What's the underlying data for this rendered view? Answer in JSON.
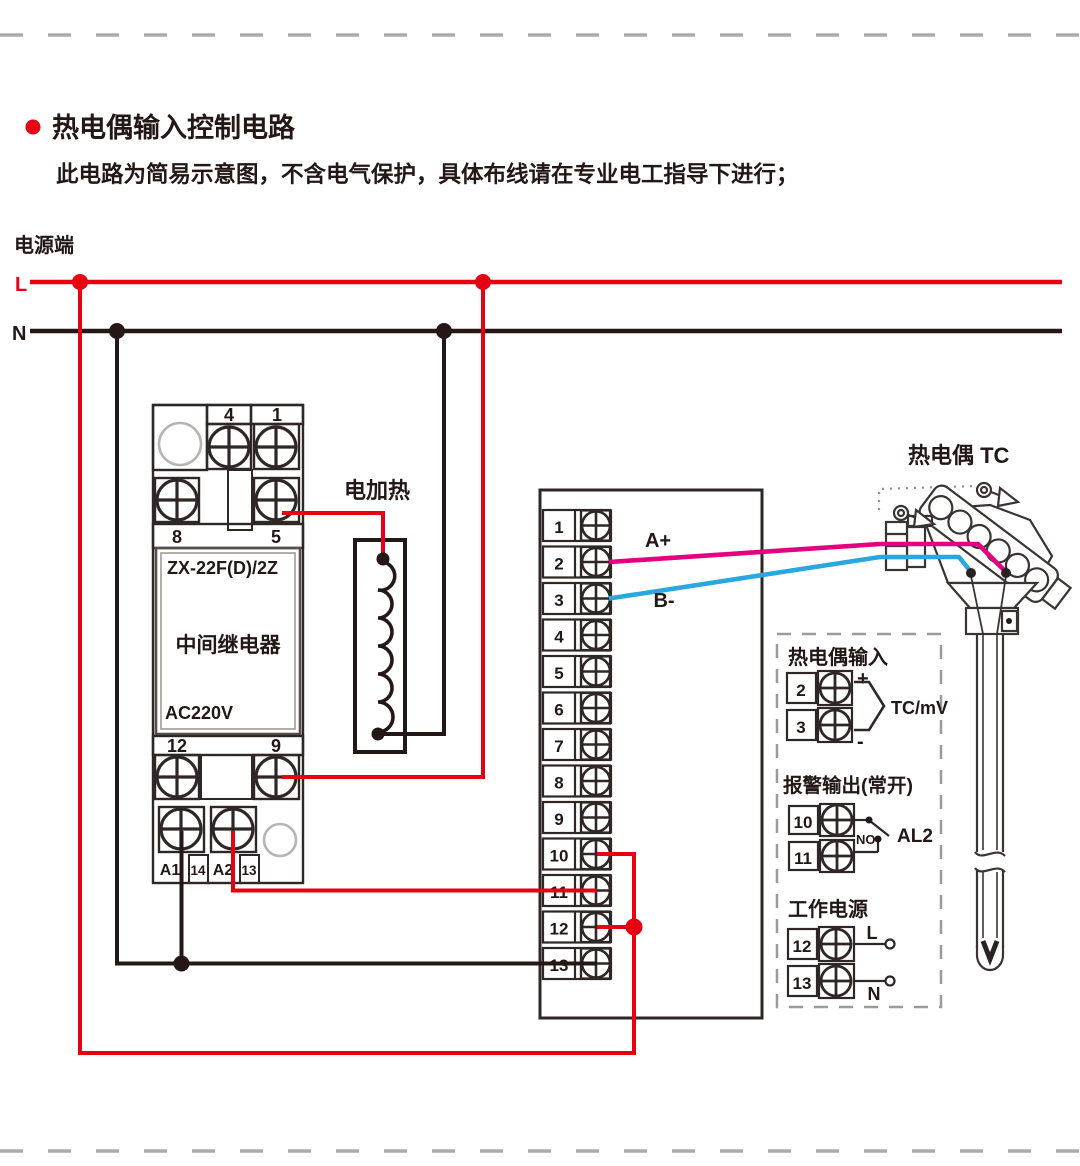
{
  "header": {
    "title": "热电偶输入控制电路",
    "subtitle": "此电路为简易示意图，不含电气保护，具体布线请在专业电工指导下进行；"
  },
  "power": {
    "label": "电源端",
    "live_label": "L",
    "neutral_label": "N",
    "live_color": "#e60012",
    "neutral_color": "#231815"
  },
  "relay": {
    "top_terminals": [
      "4",
      "1"
    ],
    "mid_terminals": [
      "8",
      "5"
    ],
    "model": "ZX-22F(D)/2Z",
    "name": "中间继电器",
    "voltage": "AC220V",
    "lower_terminals": [
      "12",
      "9"
    ],
    "coil_terminals": [
      "A1",
      "14",
      "A2",
      "13"
    ]
  },
  "heater": {
    "label": "电加热"
  },
  "terminal_block": {
    "terminals": [
      "1",
      "2",
      "3",
      "4",
      "5",
      "6",
      "7",
      "8",
      "9",
      "10",
      "11",
      "12",
      "13"
    ]
  },
  "wires": {
    "tc_plus_label": "A+",
    "tc_minus_label": "B-",
    "tc_plus_color": "#e4007f",
    "tc_minus_color": "#2ba7e0"
  },
  "thermocouple": {
    "label": "热电偶 TC"
  },
  "io_panel": {
    "tc_input": {
      "title": "热电偶输入",
      "terminals": [
        "2",
        "3"
      ],
      "plus": "+",
      "minus": "-",
      "signal": "TC/mV"
    },
    "alarm": {
      "title": "报警输出(常开)",
      "terminals": [
        "10",
        "11"
      ],
      "contact": "NO",
      "output": "AL2"
    },
    "supply": {
      "title": "工作电源",
      "terminals": [
        "12",
        "13"
      ],
      "live": "L",
      "neutral": "N"
    }
  }
}
